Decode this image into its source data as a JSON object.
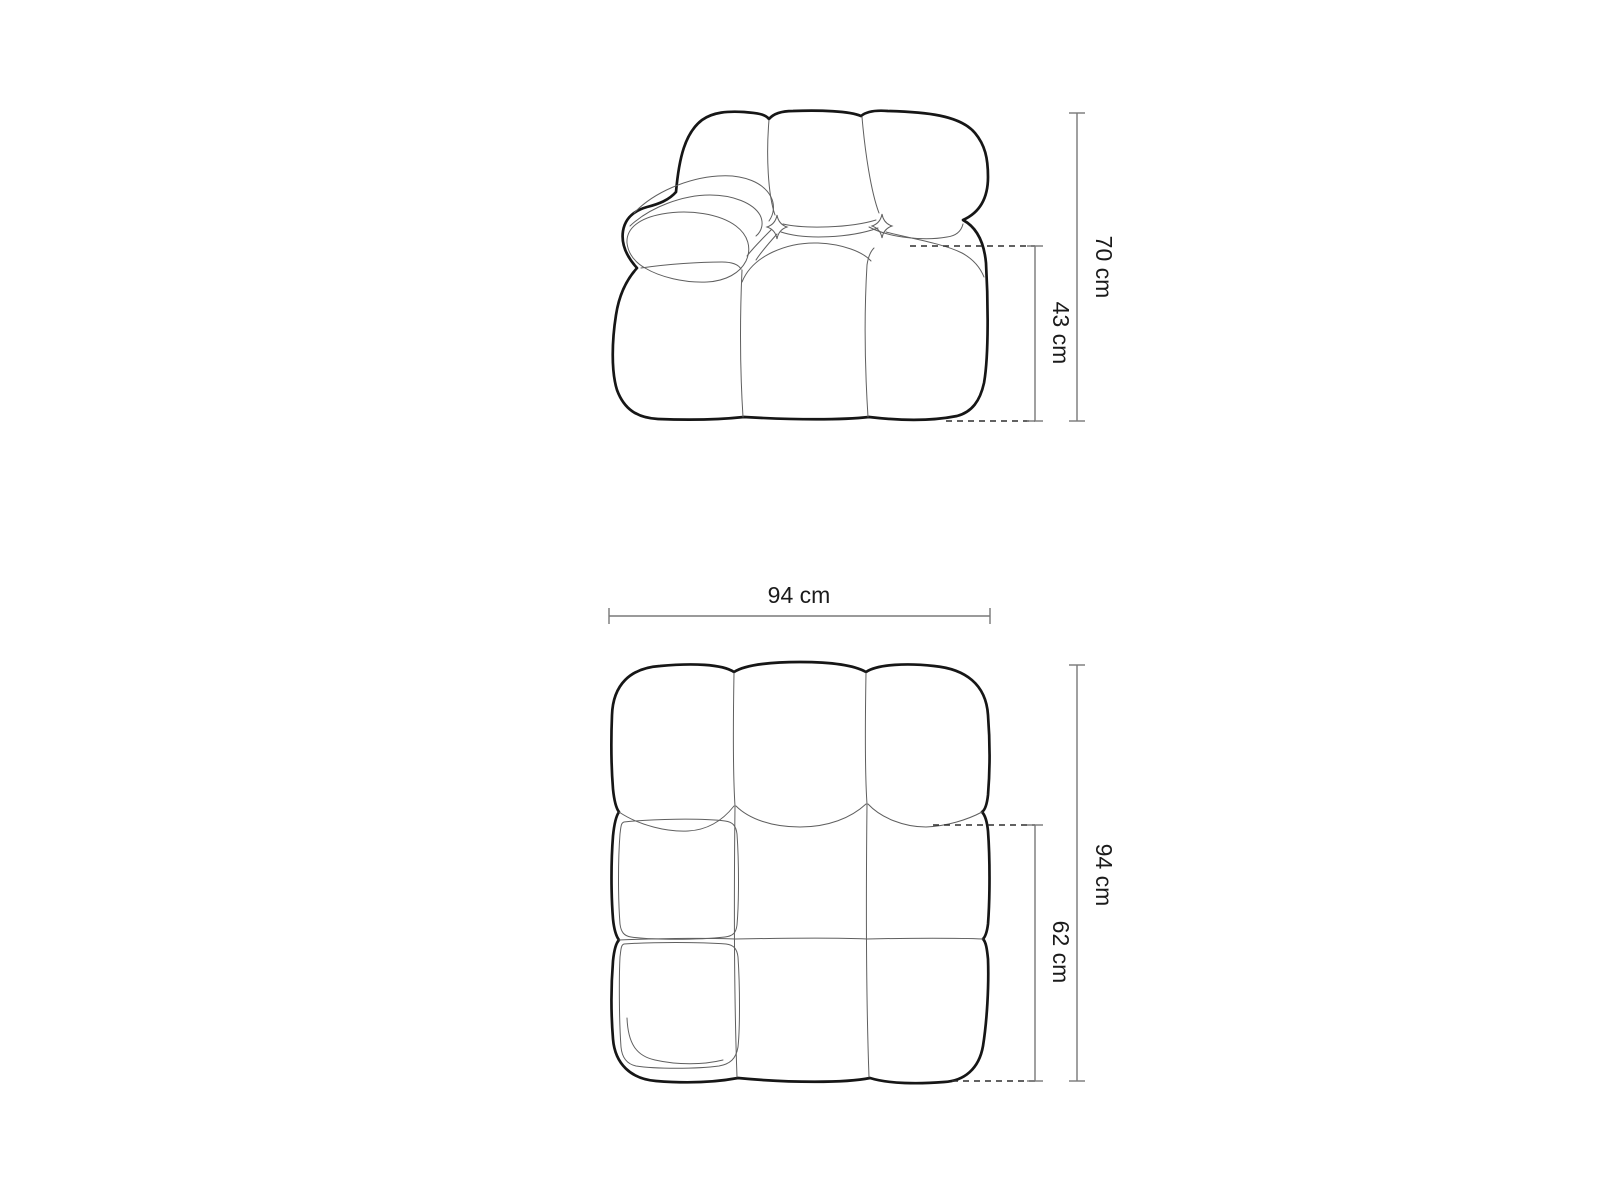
{
  "diagram": {
    "front_view": {
      "height_label": "70 cm",
      "seat_height_label": "43 cm"
    },
    "top_view": {
      "width_label": "94 cm",
      "depth_label": "94 cm",
      "seat_depth_label": "62 cm"
    }
  },
  "colors": {
    "background": "#ffffff",
    "outline": "#161616",
    "detail_line": "#5f5f5f",
    "dimension_line": "#787878",
    "dashed_line": "#2f2f2f",
    "label_text": "#1b1b1b"
  }
}
